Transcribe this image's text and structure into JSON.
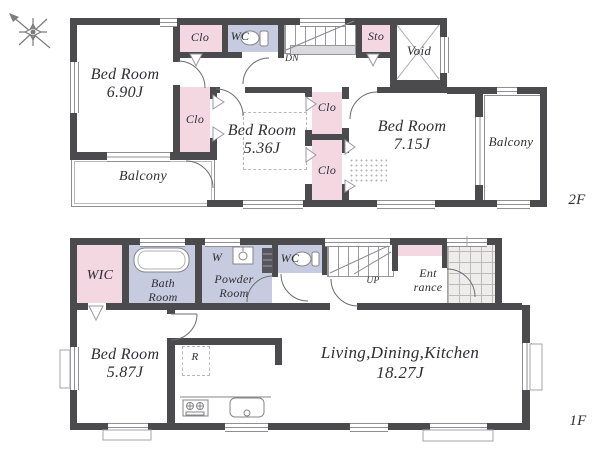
{
  "floor2": {
    "floor_label": "2F",
    "bedroom_a": {
      "name": "Bed Room",
      "size": "6.90J"
    },
    "bedroom_b": {
      "name": "Bed Room",
      "size": "5.36J"
    },
    "bedroom_c": {
      "name": "Bed Room",
      "size": "7.15J"
    },
    "closet_top": "Clo",
    "closet_mid": "Clo",
    "closet_c1": "Clo",
    "closet_c2": "Clo",
    "wc": "WC",
    "storage": "Sto",
    "void": "Void",
    "balcony_left": "Balcony",
    "balcony_right": "Balcony",
    "stair_dir": "DN"
  },
  "floor1": {
    "floor_label": "1F",
    "wic": "WIC",
    "bath": {
      "l1": "Bath",
      "l2": "Room"
    },
    "washer": "W",
    "powder": {
      "l1": "Powder",
      "l2": "Room"
    },
    "wc": "WC",
    "stair_dir": "UP",
    "entrance": {
      "l1": "Ent",
      "l2": "rance"
    },
    "bedroom": {
      "name": "Bed Room",
      "size": "5.87J"
    },
    "fridge": "R",
    "ldk": {
      "name": "Living,Dining,Kitchen",
      "size": "18.27J"
    }
  },
  "colors": {
    "wall": "#4b4b4d",
    "closet_pink": "#f3d8e2",
    "wet_blue": "#c7cbdf"
  }
}
